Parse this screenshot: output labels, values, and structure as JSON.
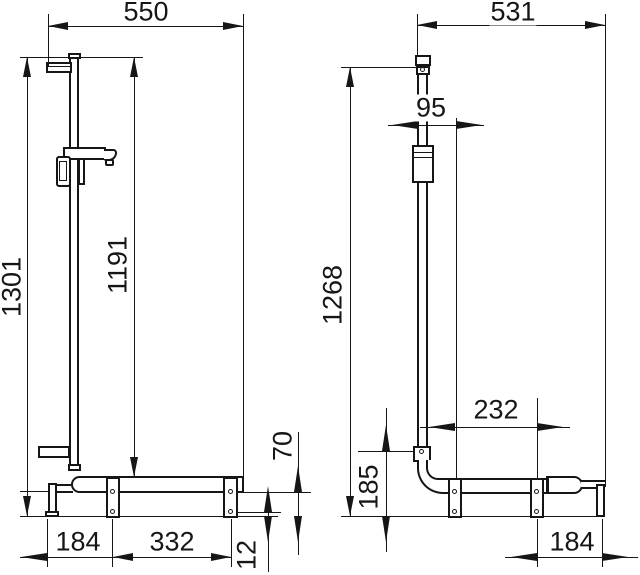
{
  "front_view": {
    "width": "550",
    "overall_height": "1301",
    "rail_height": "1191",
    "bar_clearance": "70",
    "base_offset": "12",
    "foot_to_plate": "184",
    "plate_spacing": "332"
  },
  "side_view": {
    "width": "531",
    "rail_offset": "95",
    "overall_height": "1268",
    "plate_spacing": "232",
    "bracket_height": "185",
    "plate_to_end": "184"
  }
}
